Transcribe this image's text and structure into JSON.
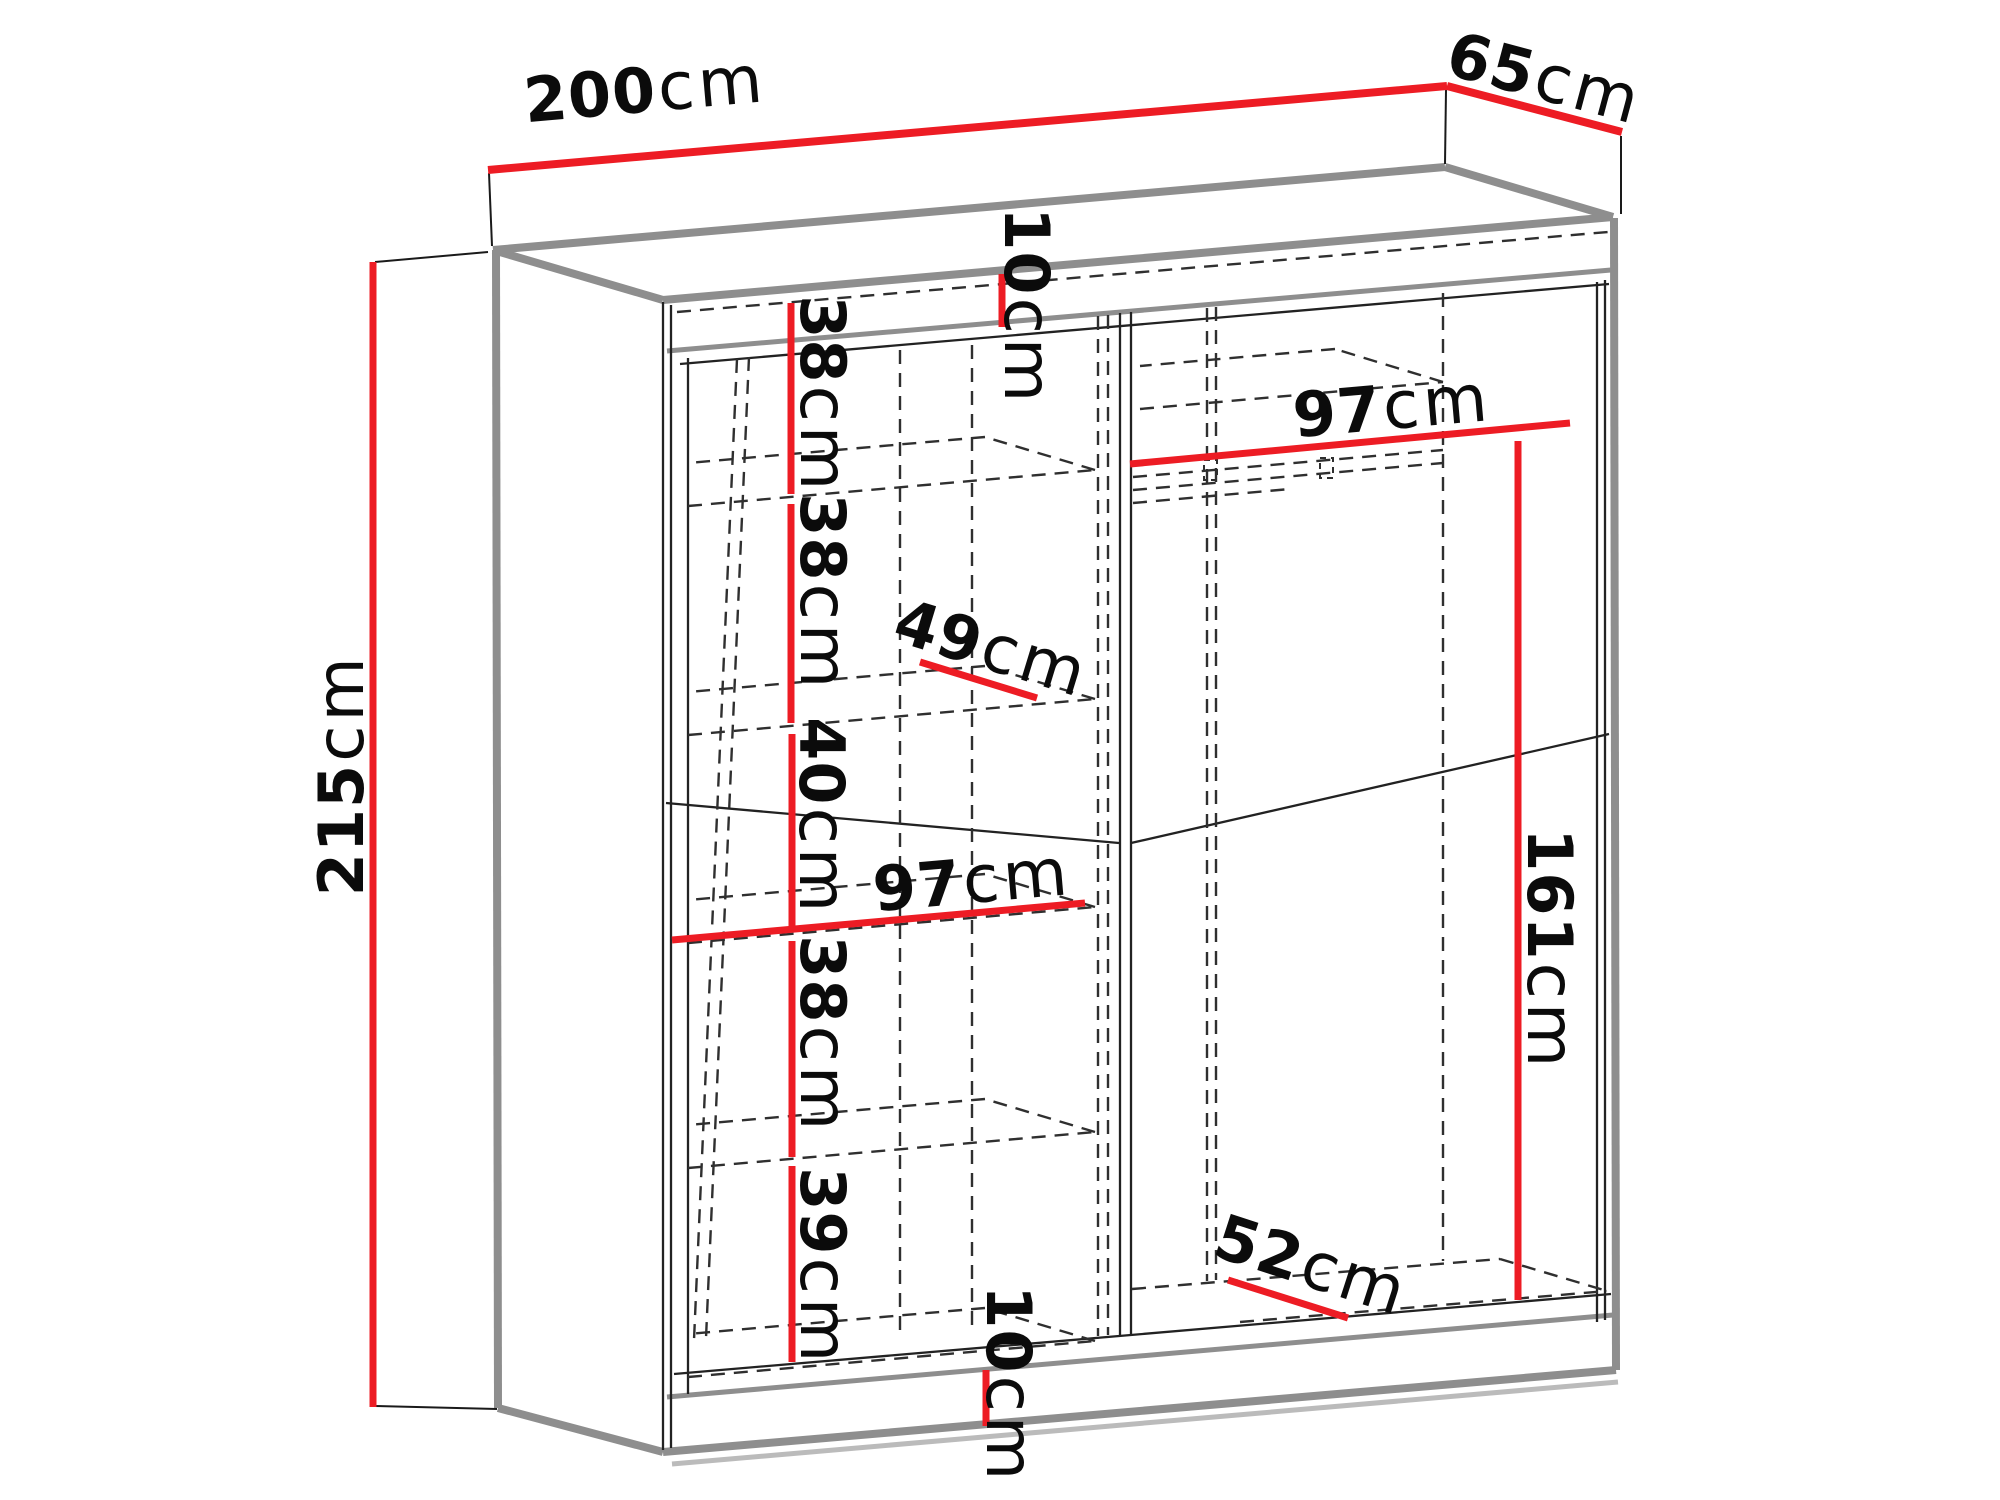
{
  "diagram": {
    "type": "furniture-dimension-diagram",
    "subject": "two-door sliding wardrobe wireframe with red dimension lines",
    "unit": "cm",
    "accent_color": "#ed1c24",
    "edge_color": "#8e8e8e",
    "hidden_line_color": "#2f2f2f",
    "labels": {
      "width": {
        "value": "200",
        "unit": "cm"
      },
      "depth": {
        "value": "65",
        "unit": "cm"
      },
      "height": {
        "value": "215",
        "unit": "cm"
      },
      "top_gap": {
        "value": "10",
        "unit": "cm"
      },
      "left_shelf_1": {
        "value": "38",
        "unit": "cm"
      },
      "left_shelf_2": {
        "value": "38",
        "unit": "cm"
      },
      "left_shelf_3": {
        "value": "40",
        "unit": "cm"
      },
      "shelf_depth": {
        "value": "49",
        "unit": "cm"
      },
      "left_width": {
        "value": "97",
        "unit": "cm"
      },
      "left_shelf_4": {
        "value": "38",
        "unit": "cm"
      },
      "left_shelf_5": {
        "value": "39",
        "unit": "cm"
      },
      "bottom_gap": {
        "value": "10",
        "unit": "cm"
      },
      "right_bottom_depth": {
        "value": "52",
        "unit": "cm"
      },
      "right_width": {
        "value": "97",
        "unit": "cm"
      },
      "hanging_height": {
        "value": "161",
        "unit": "cm"
      }
    }
  }
}
